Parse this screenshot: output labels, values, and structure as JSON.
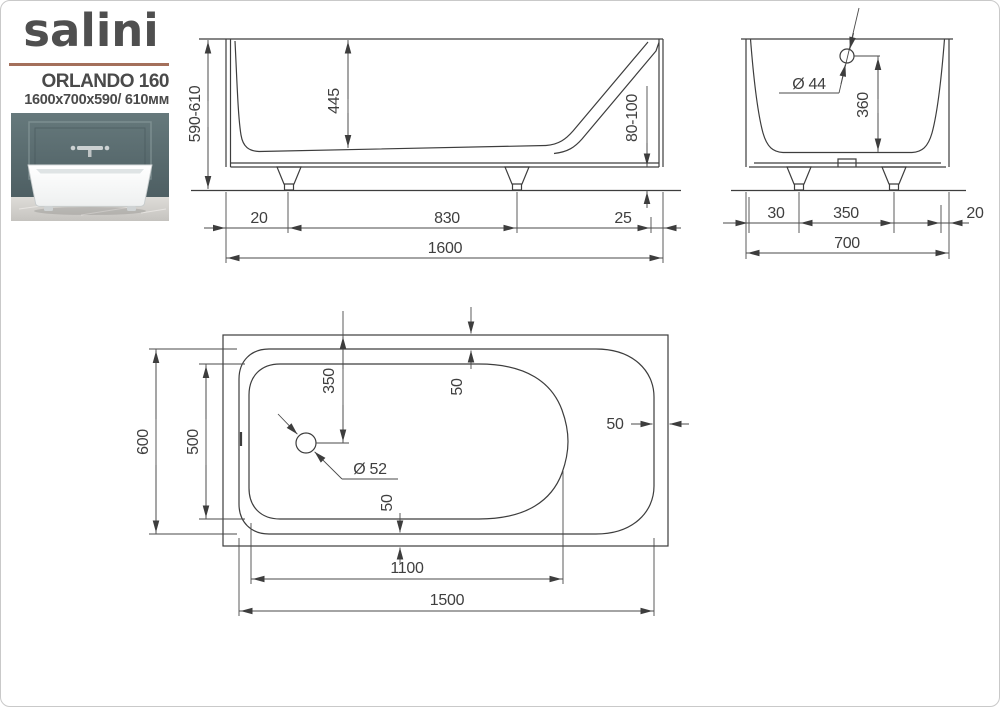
{
  "brand": {
    "logo_text": "salini",
    "model": "ORLANDO 160",
    "dimensions_line": "1600x700x590/ 610мм"
  },
  "colors": {
    "divider_accent": "#a4705b",
    "drawing_line": "#3d3d3d",
    "label_text": "#3f3f3f",
    "logo_text": "#4f4f4f",
    "photo_wall": "#5d6e71",
    "photo_floor": "#d7d5d1"
  },
  "side_view": {
    "height_range": "590-610",
    "inner_depth": "445",
    "foot_height_range": "80-100",
    "left_foot_offset": "20",
    "feet_spacing": "830",
    "right_edge_offset": "25",
    "total_length": "1600"
  },
  "end_view": {
    "overflow_diameter": "Ø 44",
    "overflow_height": "360",
    "left_foot_offset": "30",
    "feet_spacing": "350",
    "right_edge_offset": "20",
    "total_width": "700"
  },
  "plan_view": {
    "inner_rim_width": "600",
    "floor_width": "500",
    "drain_offset": "350",
    "drain_diameter": "Ø 52",
    "rim_gap_top": "50",
    "rim_gap_right": "50",
    "rim_gap_bottom": "50",
    "floor_length": "1100",
    "inner_rim_length": "1500"
  }
}
